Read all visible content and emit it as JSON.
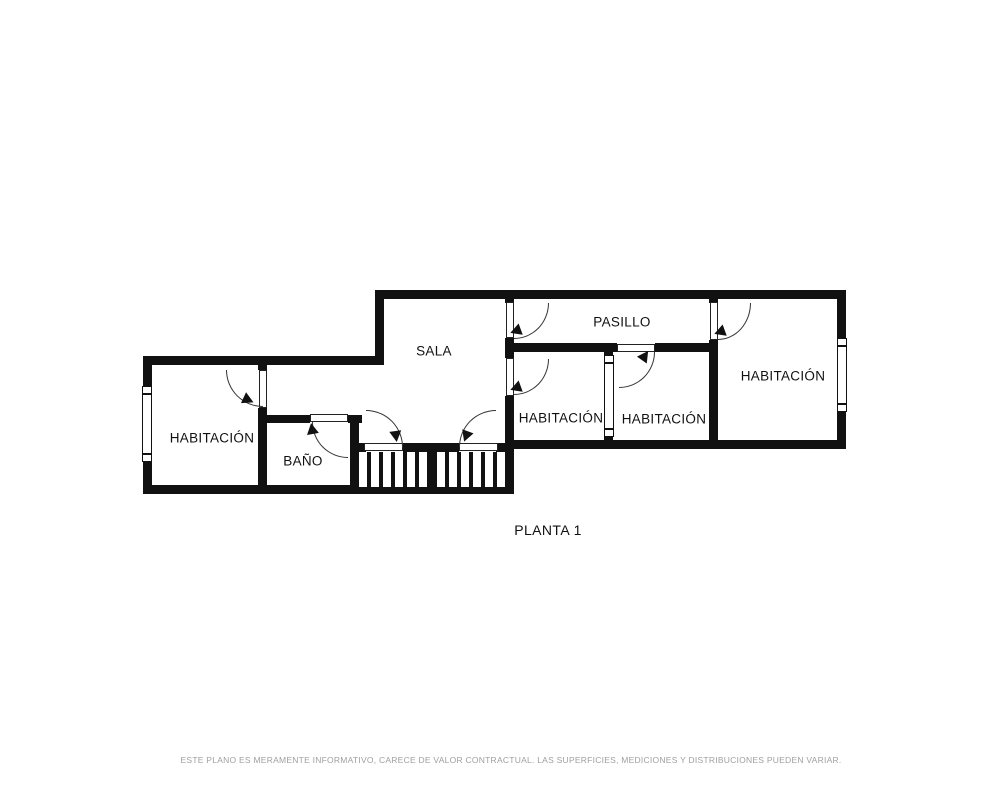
{
  "title": {
    "floor_label": "PLANTA 1"
  },
  "rooms": {
    "bedroom_left": "HABITACIÓN",
    "bathroom": "BAÑO",
    "living_room": "SALA",
    "hallway": "PASILLO",
    "bedroom_mid_1": "HABITACIÓN",
    "bedroom_mid_2": "HABITACIÓN",
    "bedroom_right": "HABITACIÓN"
  },
  "footer": {
    "disclaimer": "ESTE PLANO ES MERAMENTE INFORMATIVO, CARECE DE VALOR CONTRACTUAL. LAS SUPERFICIES, MEDICIONES Y DISTRIBUCIONES PUEDEN VARIAR."
  },
  "colors": {
    "wall": "#111111",
    "label_text": "#111111",
    "disclaimer_text": "#9f9f9f",
    "background": "#ffffff"
  }
}
